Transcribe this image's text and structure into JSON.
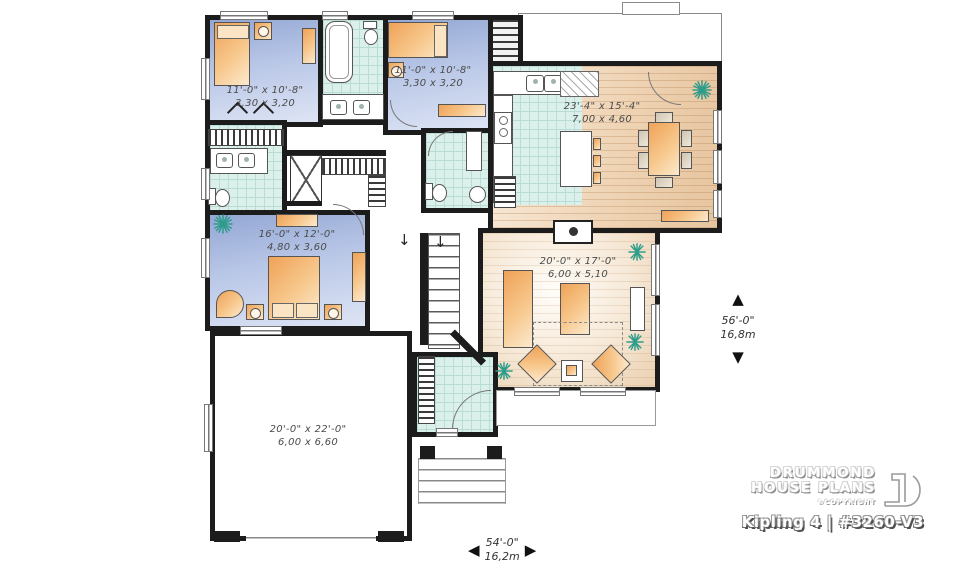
{
  "branding": {
    "name_line1": "DRUMMOND",
    "name_line2": "HOUSE PLANS",
    "copyright": "©COPYRIGHT",
    "plan_title": "Kipling 4 | #3260-V3"
  },
  "rooms": {
    "bedroom1": {
      "imperial": "11'-0\" x 10'-8\"",
      "metric": "3,30 x 3,20"
    },
    "bedroom2": {
      "imperial": "11'-0\" x 10'-8\"",
      "metric": "3,30 x 3,20"
    },
    "kitchen_dining": {
      "imperial": "23'-4\" x 15'-4\"",
      "metric": "7,00 x 4,60"
    },
    "master_bedroom": {
      "imperial": "16'-0\" x 12'-0\"",
      "metric": "4,80 x 3,60"
    },
    "living_room": {
      "imperial": "20'-0\" x 17'-0\"",
      "metric": "6,00 x 5,10"
    },
    "garage": {
      "imperial": "20'-0\" x 22'-0\"",
      "metric": "6,00 x 6,60"
    }
  },
  "overall_dimensions": {
    "depth": {
      "imperial": "56'-0\"",
      "metric": "16,8m"
    },
    "width": {
      "imperial": "54'-0\"",
      "metric": "16,2m"
    }
  },
  "icons": {
    "stairs_down": "↓",
    "dim_up": "▲",
    "dim_down": "▼",
    "dim_left": "◀",
    "dim_right": "▶",
    "plant": "8-spoke asterisk"
  },
  "colors": {
    "wall": "#1c1c1c",
    "bedroom_floor": "#a7b7dd",
    "tile_floor": "#dbf0ea",
    "wood_floor": "#ecd0ae",
    "furniture": "#f5bc79",
    "plant": "#2e9c8b",
    "label_text": "#4b4b4b"
  }
}
